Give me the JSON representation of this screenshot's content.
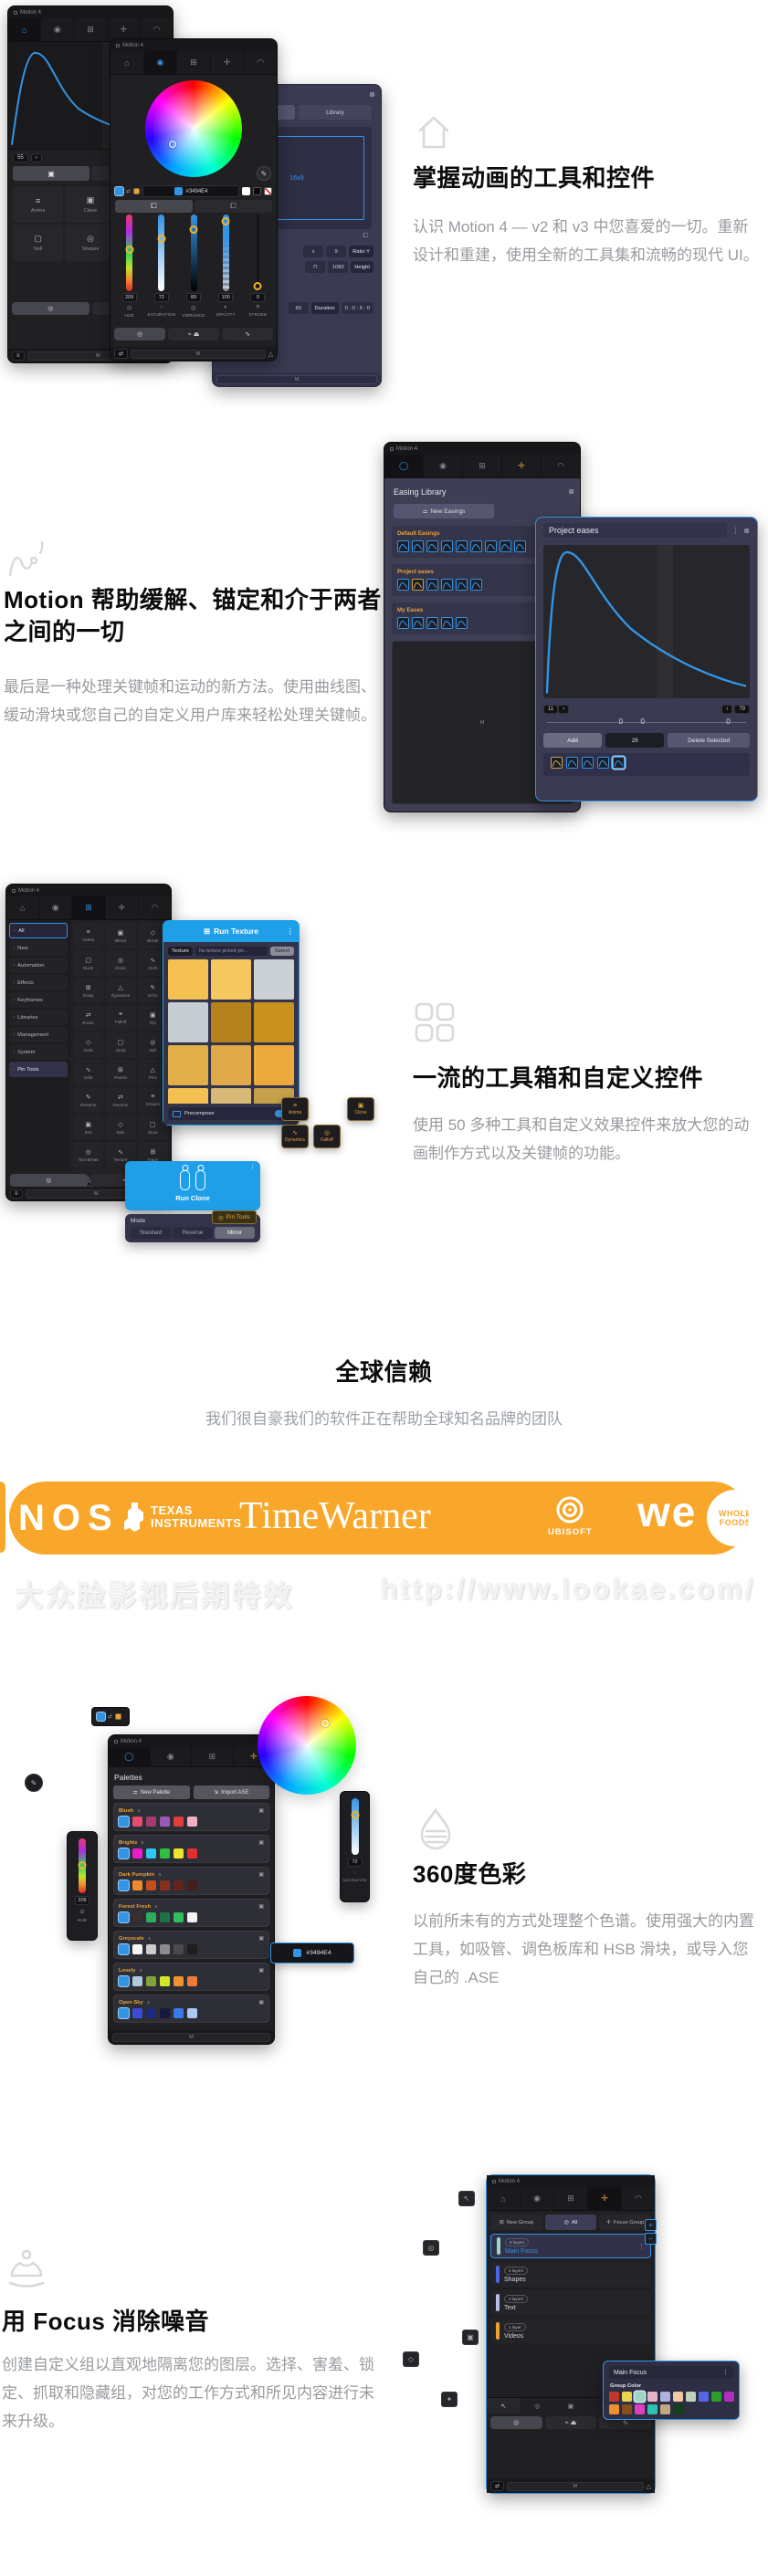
{
  "accent": "#3494E4",
  "banner_color": "#F9A72B",
  "features": {
    "f1": {
      "title": "掌握动画的工具和控件",
      "body": "认识 Motion 4 — v2 和 v3 中您喜爱的一切。重新设计和重建，使用全新的工具集和流畅的现代 UI。"
    },
    "f2": {
      "title": "Motion 帮助缓解、锚定和介于两者之间的一切",
      "body": "最后是一种处理关键帧和运动的新方法。使用曲线图、缓动滑块或您自己的自定义用户库来轻松处理关键帧。"
    },
    "f3": {
      "title": "一流的工具箱和自定义控件",
      "body": "使用 50 多种工具和自定义效果控件来放大您的动画制作方式以及关键帧的功能。"
    },
    "f4": {
      "title": "全球信赖",
      "subtitle": "我们很自豪我们的软件正在帮助全球知名品牌的团队"
    },
    "f5": {
      "title": "360度色彩",
      "body": "以前所未有的方式处理整个色谱。使用强大的内置工具，如吸管、调色板库和 HSB 滑块，或导入您自己的 .ASE"
    },
    "f6": {
      "title": "用 Focus 消除噪音",
      "body": "创建自定义组以直观地隔离您的图层。选择、害羞、锁定、抓取和隐藏组，对您的工作方式和所见内容进行未来升级。"
    }
  },
  "logos": {
    "nos": "NOS",
    "ti_top": "TEXAS",
    "ti_bottom": "INSTRUMENTS",
    "timewarner": "TimeWarner",
    "ubisoft": "UBISOFT",
    "we": "we",
    "wf_top": "WHOLE",
    "wf_bottom": "FOODS"
  },
  "watermark": {
    "left": "大众脸影视后期特效",
    "right": "http://www.lookae.com/"
  },
  "win_anim": {
    "title": "Motion 4",
    "value": "55",
    "tools": [
      "Anima",
      "Clone",
      "Delay",
      "Null",
      "Shapes",
      "Texture"
    ],
    "bottom": "M"
  },
  "win_color": {
    "title": "Motion 4",
    "hex": "#3494E4",
    "bottom": "M",
    "sliders": [
      {
        "label": "HUE",
        "value": "209"
      },
      {
        "label": "SATURATION",
        "value": "72"
      },
      {
        "label": "VIBRANCE",
        "value": "89"
      },
      {
        "label": "OPACITY",
        "value": "100"
      },
      {
        "label": "STROKE",
        "value": "0"
      }
    ]
  },
  "win_project": {
    "tab": "Library",
    "canvas": "16x9",
    "x": "x",
    "nine": "9",
    "ratio": "Ratio Y",
    "height_val": "1080",
    "height": "Height",
    "fps": "60",
    "duration": "Duration",
    "duration_val": "0 : 0 : 5 : 0",
    "bottom": "M"
  },
  "win_easing": {
    "title": "Motion 4",
    "panel": "Easing Library",
    "new_btn": "New Easings",
    "groups": [
      "Default Easings",
      "Project eases",
      "My Eases"
    ],
    "bottom": "M"
  },
  "win_eases": {
    "title": "Project eases",
    "left_val": "11",
    "right_val": "79",
    "zeros": [
      "0",
      "0",
      "0"
    ],
    "add": "Add",
    "count": "28",
    "del": "Delete Selected"
  },
  "win_toolbox": {
    "title": "Motion 4",
    "sidebar": [
      "All",
      "New",
      "Automation",
      "Effects",
      "Keyframes",
      "Libraries",
      "Management",
      "System",
      "Pin Tools"
    ],
    "grid": [
      "Anima",
      "Blend",
      "Break",
      "Burst",
      "Clone",
      "Cloth",
      "Delay",
      "Dynamics",
      "Echo",
      "Excite",
      "Falloff",
      "Flip",
      "Grab",
      "Jump",
      "Null",
      "Orbit",
      "Parent",
      "Pins",
      "Rename",
      "Reverse",
      "Shapes",
      "Sort",
      "Spin",
      "Store",
      "Text-Break",
      "Texture",
      "Trace",
      "Trash",
      "Trim"
    ],
    "bottom": "M"
  },
  "run_texture": {
    "title": "Run Texture",
    "chip": "Texture",
    "field": "No texture picked yet...",
    "select": "Select",
    "precompose": "Precompose",
    "swatches": [
      "#F4C052",
      "#F6C75E",
      "#CBD0D4",
      "#C6CDD2",
      "#B5821D",
      "#C9921E",
      "#E2AF4B",
      "#E0A94A",
      "#ECA93D",
      "#F4C052",
      "#D9B977",
      "#C7A04B"
    ]
  },
  "chips": {
    "anima": "Anima",
    "clone": "Clone",
    "dynamics": "Dynamics",
    "falloff": "Falloff",
    "pin": "Pin Tools"
  },
  "run_clone": {
    "title": "Run Clone",
    "mode": "Mode",
    "options": [
      "Standard",
      "Reverse",
      "Mirror"
    ]
  },
  "win_palettes": {
    "title": "Motion 4",
    "panel": "Palettes",
    "new_btn": "New Palette",
    "import_btn": "Import ASE",
    "bottom": "M",
    "hex": "#3494E4",
    "hue": {
      "label": "HUE",
      "value": "209"
    },
    "saturation": {
      "label": "SATURATION",
      "value": "72"
    },
    "groups": [
      {
        "name": "Blush",
        "colors": [
          "#3494E4",
          "#E84A6F",
          "#A43B6E",
          "#9B59B6",
          "#E43B3B",
          "#F2AEC0"
        ]
      },
      {
        "name": "Brights",
        "colors": [
          "#3494E4",
          "#E81ECB",
          "#2EC8F0",
          "#2EBE41",
          "#F0E32E",
          "#E42E2E"
        ]
      },
      {
        "name": "Dark Pumpkin",
        "colors": [
          "#3494E4",
          "#F08A2E",
          "#C44E1E",
          "#8A2E1E",
          "#63241A",
          "#471F1A"
        ]
      },
      {
        "name": "Forest Fresh",
        "colors": [
          "#3494E4",
          "#3A2F2F",
          "#2EAE5B",
          "#1F7045",
          "#2EBE5B",
          "#F2F2F2"
        ]
      },
      {
        "name": "Greyscale",
        "colors": [
          "#3494E4",
          "#F5F5F5",
          "#CCCCCC",
          "#8C8C8C",
          "#4A4A4A",
          "#1E1E1E"
        ]
      },
      {
        "name": "Lovely",
        "colors": [
          "#3494E4",
          "#AFC9DD",
          "#7FA23B",
          "#D4E82A",
          "#F0922E",
          "#F07A3A"
        ]
      },
      {
        "name": "Open Sky",
        "colors": [
          "#3494E4",
          "#3D4BD6",
          "#1E2B7E",
          "#131A3E",
          "#3A7AE8",
          "#A9C8F2"
        ]
      }
    ]
  },
  "win_focus": {
    "title": "Motion 4",
    "buttons": [
      "New Group",
      "All",
      "Focus Group"
    ],
    "bottom": "M",
    "groups": [
      {
        "badge": "5 layers",
        "name": "Main Focus",
        "color": "#9AD6C8"
      },
      {
        "badge": "4 layers",
        "name": "Shapes",
        "color": "#4A66E8"
      },
      {
        "badge": "2 layers",
        "name": "Text",
        "color": "#B9BCE8"
      },
      {
        "badge": "1 layer",
        "name": "Videos",
        "color": "#F0A030"
      }
    ],
    "overlay": {
      "title": "Main Focus",
      "label": "Group Color",
      "colors": [
        "#C0392B",
        "#E8D44D",
        "#9FD4C4",
        "#E8B4C8",
        "#AEB2E0",
        "#F0C9A0",
        "#BFD4BF",
        "#5468E0",
        "#2E9E2E",
        "#B02EC0",
        "#F09030",
        "#8A4E1E",
        "#E040C0",
        "#2EC0B0",
        "#C0A880",
        "#123F1C"
      ]
    }
  }
}
